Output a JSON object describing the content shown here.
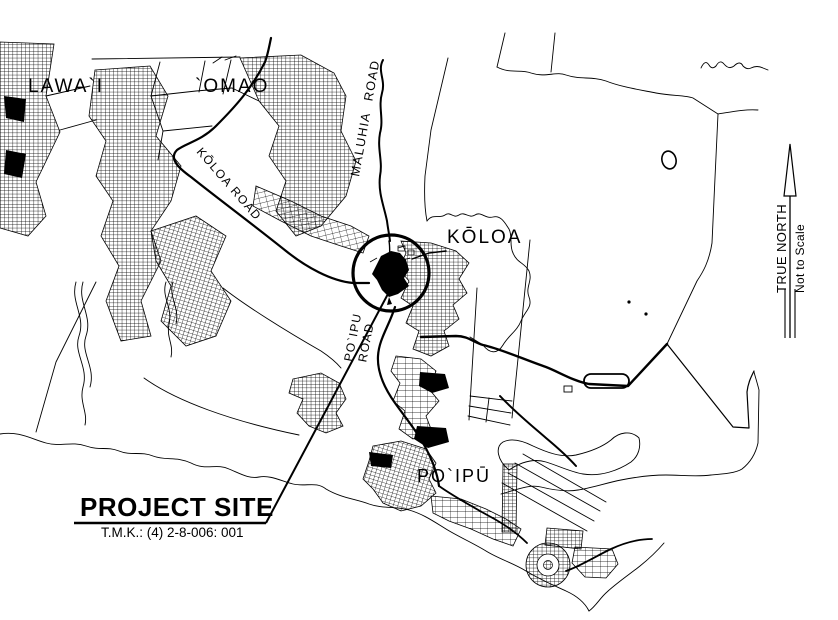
{
  "map": {
    "colors": {
      "ink": "#000000",
      "background": "#ffffff"
    },
    "places": {
      "lawai": "LAWA`I",
      "omao": "`OMAO",
      "koloa": "KŌLOA",
      "poipu": "PO`IPŪ"
    },
    "roads": {
      "koloa_road": "KŌLOA ROAD",
      "maluhia_road": "MALUHIA ROAD",
      "poipu_road_line1": "PO`IPU",
      "poipu_road_line2": "ROAD"
    },
    "callout": {
      "label": "PROJECT SITE",
      "tmk": "T.M.K.: (4) 2-8-006: 001"
    },
    "north_arrow": {
      "label": "TRUE NORTH",
      "note": "Not to Scale"
    }
  }
}
